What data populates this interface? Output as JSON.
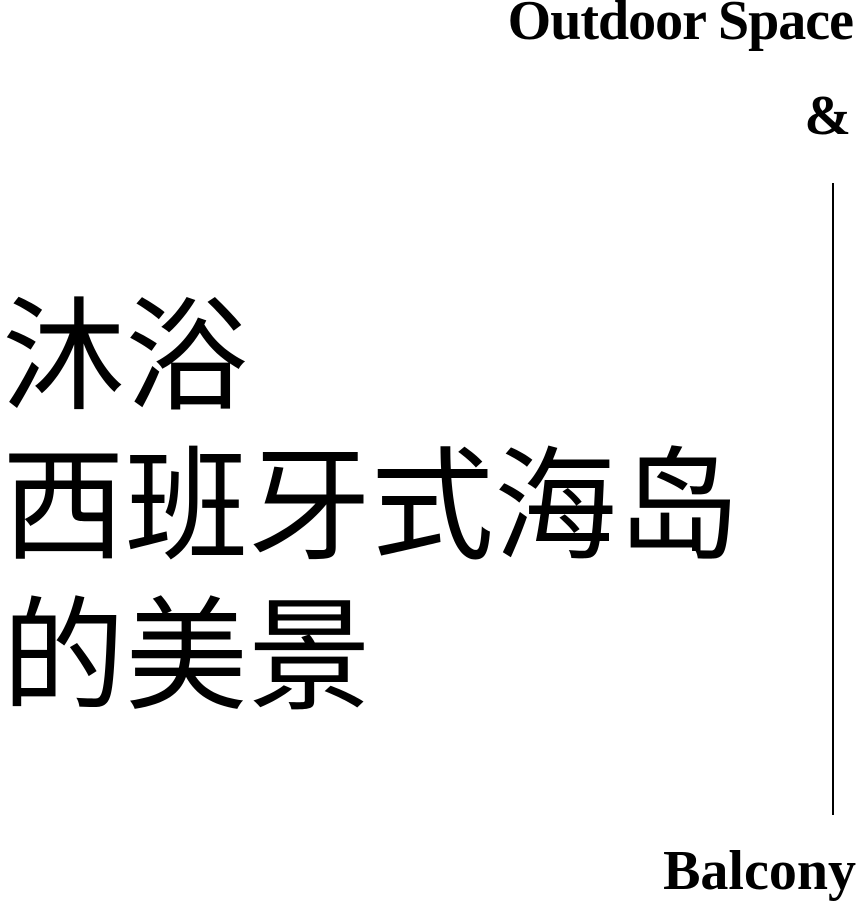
{
  "colors": {
    "background": "#ffffff",
    "ink": "#000000"
  },
  "header": {
    "title_en": "Outdoor Space",
    "ampersand": "&"
  },
  "chinese_title": {
    "lines": [
      "沐浴",
      "西班牙式海岛",
      "的美景"
    ]
  },
  "footer": {
    "label_en": "Balcony"
  }
}
